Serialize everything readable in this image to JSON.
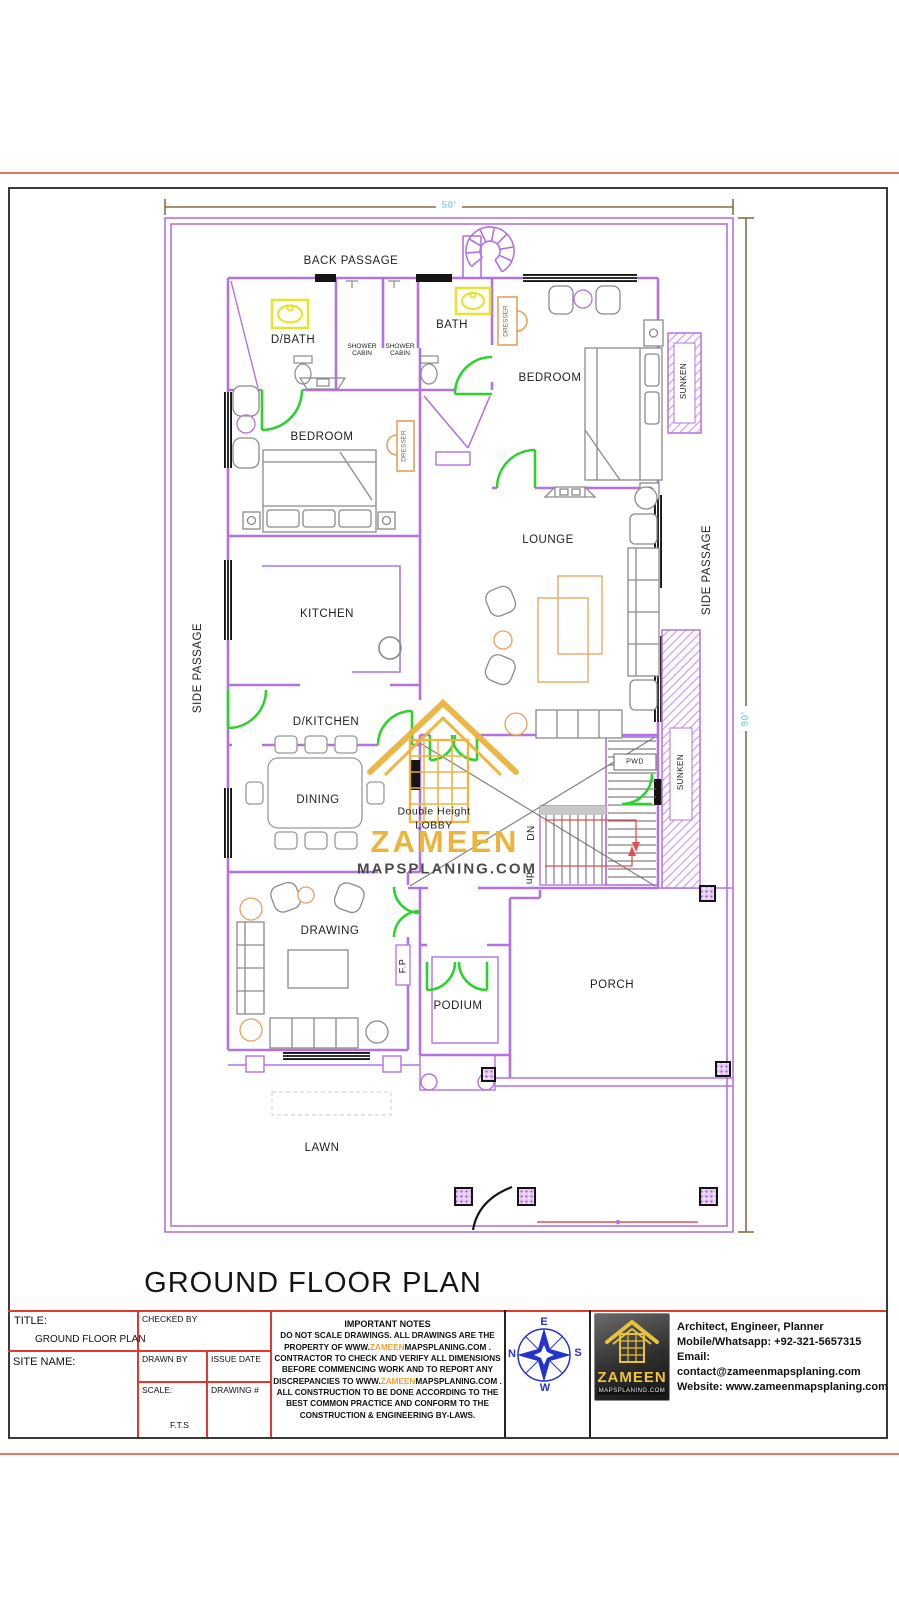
{
  "colors": {
    "wall_purple": "#b472e0",
    "door_green": "#2fd12f",
    "dimension_line_brown": "#8a6d3f",
    "dimension_text_cyan": "#8fd9e6",
    "fixture_yellow": "#e8e232",
    "furniture_gray": "#8a8a8a",
    "accent_orange": "#e6a05f",
    "watermark_gold": "#ecb43c",
    "table_border_red": "#e03a2e",
    "compass_blue": "#2433cc",
    "sheet_border": "#3a3a3a"
  },
  "plan": {
    "dimensions": {
      "width_label": "50'",
      "height_label": "90'"
    },
    "rooms": {
      "back_passage": "BACK PASSAGE",
      "d_bath": "D/BATH",
      "shower_cabin_line1": "SHOWER",
      "shower_cabin_line2": "CABIN",
      "bath": "BATH",
      "bedroom_right": "BEDROOM",
      "bedroom_left": "BEDROOM",
      "dresser": "DRESSER",
      "sunken": "SUNKEN",
      "lounge": "LOUNGE",
      "kitchen": "KITCHEN",
      "side_passage": "SIDE PASSAGE",
      "d_kitchen": "D/KITCHEN",
      "dining": "DINING",
      "lobby_line1": "Double Height",
      "lobby_line2": "LOBBY",
      "stair_down": "DN",
      "stair_up": "up",
      "pwd": "PWD",
      "drawing": "DRAWING",
      "fireplace": "F.P",
      "podium": "PODIUM",
      "porch": "PORCH",
      "lawn": "LAWN"
    }
  },
  "watermark": {
    "brand": "ZAMEEN",
    "domain": "MAPSPLANING.COM"
  },
  "sheet": {
    "title": "GROUND FLOOR PLAN"
  },
  "title_block": {
    "title_label": "TITLE:",
    "title_value": "GROUND FLOOR PLAN",
    "site_name_label": "SITE NAME:",
    "checked_by_label": "CHECKED BY",
    "drawn_by_label": "DRAWN BY",
    "issue_date_label": "ISSUE DATE",
    "scale_label": "SCALE:",
    "scale_value": "F.T.S",
    "drawing_no_label": "DRAWING #",
    "notes_title": "IMPORTANT NOTES",
    "notes_line1": "DO NOT SCALE DRAWINGS. ALL DRAWINGS ARE THE",
    "notes_line2_pre": "PROPERTY OF  WWW.",
    "notes_line2_brand": "ZAMEEN",
    "notes_line2_post": "MAPSPLANING.COM .",
    "notes_line3": "CONTRACTOR TO CHECK AND VERIFY ALL DIMENSIONS",
    "notes_line4": "BEFORE COMMENCING WORK AND TO REPORT ANY",
    "notes_line5_pre": "DISCREPANCIES TO WWW.",
    "notes_line5_brand": "ZAMEEN",
    "notes_line5_post": "MAPSPLANING.COM .",
    "notes_line6": "ALL CONSTRUCTION TO BE DONE ACCORDING TO THE",
    "notes_line7": "BEST COMMON PRACTICE AND CONFORM TO THE",
    "notes_line8": "CONSTRUCTION & ENGINEERING BY-LAWS.",
    "compass": {
      "north": "N",
      "east": "E",
      "south": "S",
      "west": "W"
    },
    "logo": {
      "brand": "ZAMEEN",
      "domain": "MAPSPLANING.COM"
    },
    "contact_line1": "Architect, Engineer, Planner",
    "contact_line2": "Mobile/Whatsapp: +92-321-5657315",
    "contact_line3": "Email: contact@zameenmapsplaning.com",
    "contact_line4": "Website: www.zameenmapsplaning.com"
  }
}
